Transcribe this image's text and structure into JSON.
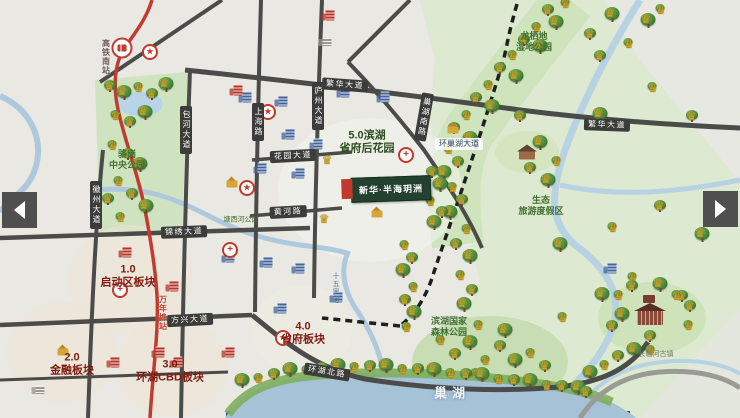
{
  "viewer": {
    "prev_button_name": "previous-image",
    "next_button_name": "next-image"
  },
  "map": {
    "colors": {
      "urban_bg": "#e9e8e2",
      "park_green": "#dde9d0",
      "forest_green": "#c9ddb4",
      "water_blue": "#aec9dd",
      "lake_blue": "#a6c2d7",
      "road_gray": "#4b4b49",
      "metro_red": "#c23b2e",
      "zone_text": "#7f1c10",
      "park_text": "#41702f"
    },
    "zone_labels": [
      {
        "lines": [
          "1.0",
          "启动区板块"
        ],
        "x": 128,
        "y": 276,
        "color": "#7f1c10",
        "size": 11
      },
      {
        "lines": [
          "2.0",
          "金融板块"
        ],
        "x": 72,
        "y": 364,
        "color": "#7f1c10",
        "size": 11
      },
      {
        "lines": [
          "3.0",
          "环湖CBD板块"
        ],
        "x": 170,
        "y": 371,
        "color": "#7f1c10",
        "size": 11
      },
      {
        "lines": [
          "4.0",
          "省府板块"
        ],
        "x": 303,
        "y": 333,
        "color": "#7f1c10",
        "size": 11
      },
      {
        "lines": [
          "5.0滨湖",
          "省府后花园"
        ],
        "x": 367,
        "y": 142,
        "color": "#2c4f1e",
        "size": 11
      }
    ],
    "road_labels": [
      {
        "label": "繁华大道",
        "x": 345,
        "y": 85,
        "rot": 4,
        "vertical": false,
        "light": false
      },
      {
        "label": "繁华大道",
        "x": 607,
        "y": 125,
        "rot": 2,
        "vertical": false,
        "light": false
      },
      {
        "label": "包河大道",
        "x": 186,
        "y": 130,
        "rot": 0,
        "vertical": true,
        "light": false
      },
      {
        "label": "上海路",
        "x": 258,
        "y": 122,
        "rot": 0,
        "vertical": true,
        "light": false
      },
      {
        "label": "庐州大道",
        "x": 318,
        "y": 106,
        "rot": 0,
        "vertical": true,
        "light": false
      },
      {
        "label": "花园大道",
        "x": 293,
        "y": 156,
        "rot": -3,
        "vertical": false,
        "light": false
      },
      {
        "label": "黄河路",
        "x": 288,
        "y": 212,
        "rot": -3,
        "vertical": false,
        "light": false
      },
      {
        "label": "锦绣大道",
        "x": 184,
        "y": 232,
        "rot": -2,
        "vertical": false,
        "light": false
      },
      {
        "label": "方兴大道",
        "x": 190,
        "y": 320,
        "rot": -3,
        "vertical": false,
        "light": false
      },
      {
        "label": "环湖北路",
        "x": 327,
        "y": 372,
        "rot": 9,
        "vertical": false,
        "light": false
      },
      {
        "label": "徽州大道",
        "x": 96,
        "y": 205,
        "rot": 0,
        "vertical": true,
        "light": false
      },
      {
        "label": "巢湖南路",
        "x": 424,
        "y": 117,
        "rot": 10,
        "vertical": true,
        "light": false
      },
      {
        "label": "环巢湖大道",
        "x": 459,
        "y": 144,
        "rot": 0,
        "vertical": false,
        "light": true
      }
    ],
    "area_labels": [
      {
        "lines": [
          "骆岗",
          "中央公园"
        ],
        "x": 127,
        "y": 160,
        "small": false
      },
      {
        "lines": [
          "龙栖地",
          "湿地公园"
        ],
        "x": 534,
        "y": 42,
        "small": false
      },
      {
        "lines": [
          "生态",
          "旅游度假区"
        ],
        "x": 541,
        "y": 206,
        "small": false
      },
      {
        "lines": [
          "滨湖国家",
          "森林公园"
        ],
        "x": 449,
        "y": 327,
        "small": false
      },
      {
        "lines": [
          "塘西河公园"
        ],
        "x": 241,
        "y": 221,
        "small": true
      }
    ],
    "water_labels": [
      {
        "label": "巢湖",
        "x": 452,
        "y": 392
      }
    ],
    "river_labels": [
      {
        "label": "十五里河",
        "x": 335,
        "y": 288
      }
    ],
    "transit": {
      "rail_station_label": {
        "text": "高铁南站",
        "x": 106,
        "y": 57
      },
      "metro_stop_label": {
        "text": "万年埠站",
        "x": 163,
        "y": 313
      }
    },
    "project": {
      "name": "新华·半海玥洲",
      "x": 391,
      "y": 189,
      "flag_x": 347,
      "flag_y": 189
    },
    "landmark_labels": [
      {
        "label": "长临河古镇",
        "x": 656,
        "y": 354
      }
    ],
    "pois": [
      {
        "type": "blue",
        "x": 247,
        "y": 97
      },
      {
        "type": "blue",
        "x": 283,
        "y": 101
      },
      {
        "type": "blue",
        "x": 345,
        "y": 92
      },
      {
        "type": "blue",
        "x": 385,
        "y": 97
      },
      {
        "type": "blue",
        "x": 290,
        "y": 134
      },
      {
        "type": "blue",
        "x": 318,
        "y": 144
      },
      {
        "type": "blue",
        "x": 262,
        "y": 168
      },
      {
        "type": "blue",
        "x": 300,
        "y": 173
      },
      {
        "type": "blue",
        "x": 230,
        "y": 257
      },
      {
        "type": "blue",
        "x": 268,
        "y": 262
      },
      {
        "type": "blue",
        "x": 300,
        "y": 268
      },
      {
        "type": "blue",
        "x": 338,
        "y": 297
      },
      {
        "type": "blue",
        "x": 282,
        "y": 308
      },
      {
        "type": "blue",
        "x": 612,
        "y": 268
      },
      {
        "type": "red",
        "x": 330,
        "y": 15
      },
      {
        "type": "red",
        "x": 238,
        "y": 90
      },
      {
        "type": "red",
        "x": 127,
        "y": 252
      },
      {
        "type": "red",
        "x": 174,
        "y": 286
      },
      {
        "type": "red",
        "x": 115,
        "y": 362
      },
      {
        "type": "red",
        "x": 160,
        "y": 352
      },
      {
        "type": "red",
        "x": 178,
        "y": 362
      },
      {
        "type": "red",
        "x": 230,
        "y": 352
      },
      {
        "type": "star",
        "x": 150,
        "y": 52
      },
      {
        "type": "star",
        "x": 268,
        "y": 112
      },
      {
        "type": "star",
        "x": 247,
        "y": 188
      },
      {
        "type": "star",
        "x": 283,
        "y": 338
      },
      {
        "type": "cross",
        "x": 120,
        "y": 290
      },
      {
        "type": "cross",
        "x": 230,
        "y": 250
      },
      {
        "type": "cross",
        "x": 406,
        "y": 155
      },
      {
        "type": "crown",
        "x": 327,
        "y": 160
      },
      {
        "type": "crown",
        "x": 324,
        "y": 219
      },
      {
        "type": "school",
        "x": 232,
        "y": 184
      },
      {
        "type": "school",
        "x": 63,
        "y": 352
      },
      {
        "type": "school",
        "x": 453,
        "y": 130
      },
      {
        "type": "school",
        "x": 377,
        "y": 214
      },
      {
        "type": "gray",
        "x": 327,
        "y": 42
      },
      {
        "type": "gray",
        "x": 40,
        "y": 390
      },
      {
        "type": "house",
        "x": 527,
        "y": 155
      },
      {
        "type": "temple",
        "x": 650,
        "y": 318
      }
    ]
  }
}
